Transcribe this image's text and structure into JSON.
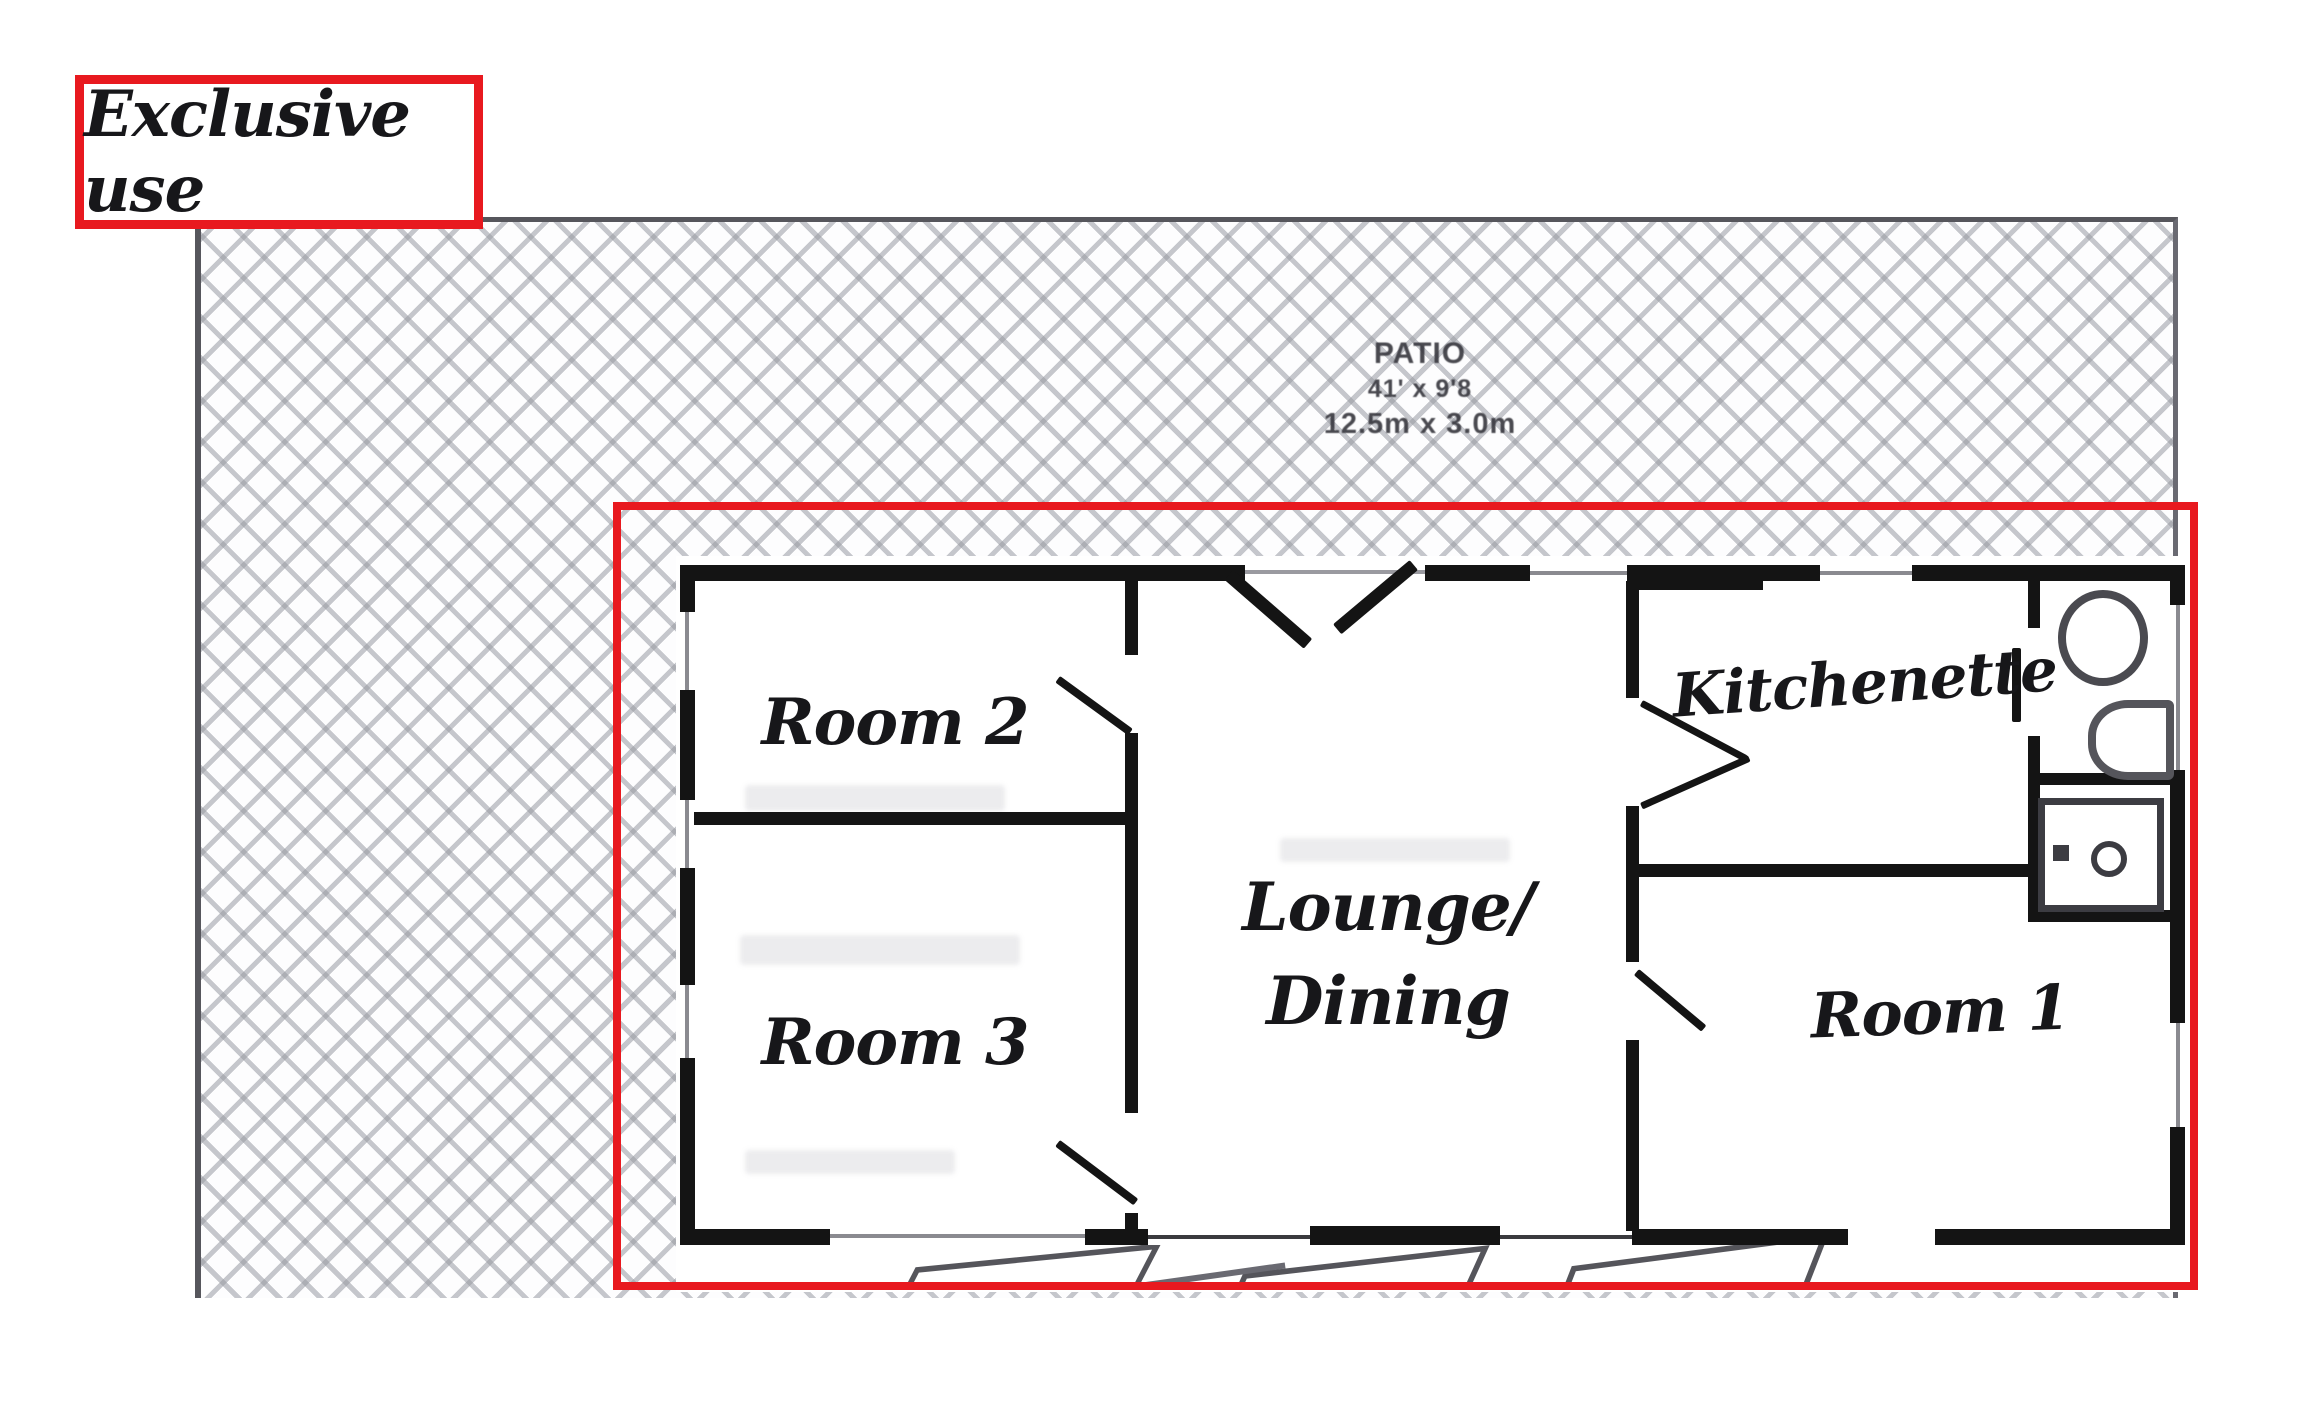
{
  "annotation": {
    "label": "Exclusive use"
  },
  "patio": {
    "title": "PATIO",
    "size_imperial": "41' x 9'8",
    "size_metric": "12.5m x 3.0m"
  },
  "rooms": {
    "room2": "Room 2",
    "room3": "Room 3",
    "lounge_line1": "Lounge/",
    "lounge_line2": "Dining",
    "kitchenette": "Kitchenette",
    "room1": "Room 1"
  },
  "colors": {
    "annotation_red": "#e8191f",
    "wall_black": "#141414",
    "hatch_gray": "#979aa2",
    "fixture_gray": "#4a4a50"
  }
}
